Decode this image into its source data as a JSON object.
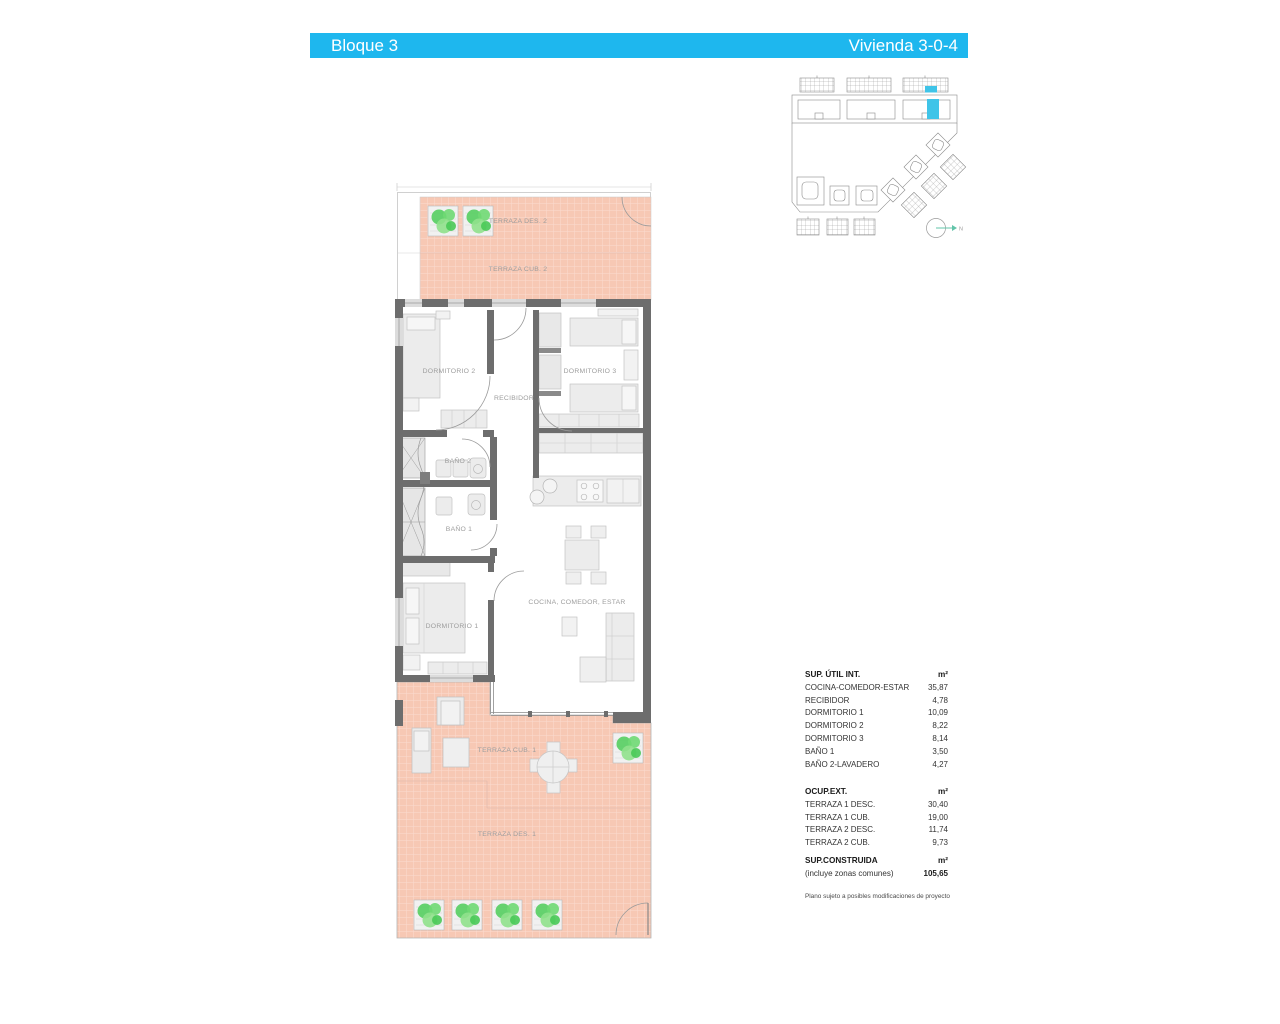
{
  "header": {
    "block_label": "Bloque 3",
    "unit_label": "Vivienda 3-0-4",
    "bar_color": "#1eb7ee"
  },
  "colors": {
    "accent_cyan": "#1eb7ee",
    "site_highlight_cyan": "#3fc4e8",
    "terrace_fill": "#f7c8b4",
    "wall_gray": "#6d6d6d",
    "plant_green": "#55ce60"
  },
  "floor_plan": {
    "rooms": {
      "terraza_des_2": "TERRAZA DES. 2",
      "terraza_cub_2": "TERRAZA CUB. 2",
      "dormitorio_2": "DORMITORIO 2",
      "dormitorio_3": "DORMITORIO 3",
      "recibidor": "RECIBIDOR",
      "bano_2": "BAÑO 2",
      "bano_1": "BAÑO 1",
      "dormitorio_1": "DORMITORIO 1",
      "cocina_comedor_estar": "COCINA, COMEDOR, ESTAR",
      "terraza_cub_1": "TERRAZA CUB. 1",
      "terraza_des_1": "TERRAZA DES. 1"
    }
  },
  "site_plan": {
    "north_label": "N"
  },
  "tables": {
    "sup_util": {
      "title": "SUP. ÚTIL INT.",
      "unit": "m²",
      "rows": [
        {
          "label": "COCINA-COMEDOR-ESTAR",
          "value": "35,87"
        },
        {
          "label": "RECIBIDOR",
          "value": "4,78"
        },
        {
          "label": "DORMITORIO 1",
          "value": "10,09"
        },
        {
          "label": "DORMITORIO 2",
          "value": "8,22"
        },
        {
          "label": "DORMITORIO 3",
          "value": "8,14"
        },
        {
          "label": "BAÑO 1",
          "value": "3,50"
        },
        {
          "label": "BAÑO 2-LAVADERO",
          "value": "4,27"
        }
      ]
    },
    "ocup_ext": {
      "title": "OCUP.EXT.",
      "unit": "m²",
      "rows": [
        {
          "label": "TERRAZA 1 DESC.",
          "value": "30,40"
        },
        {
          "label": "TERRAZA 1 CUB.",
          "value": "19,00"
        },
        {
          "label": "TERRAZA 2 DESC.",
          "value": "11,74"
        },
        {
          "label": "TERRAZA 2 CUB.",
          "value": "9,73"
        }
      ]
    },
    "sup_construida": {
      "title": "SUP.CONSTRUIDA",
      "subtitle": "(incluye zonas comunes)",
      "unit": "m²",
      "value": "105,65"
    }
  },
  "footnote": "Plano sujeto a posibles modificaciones de proyecto"
}
